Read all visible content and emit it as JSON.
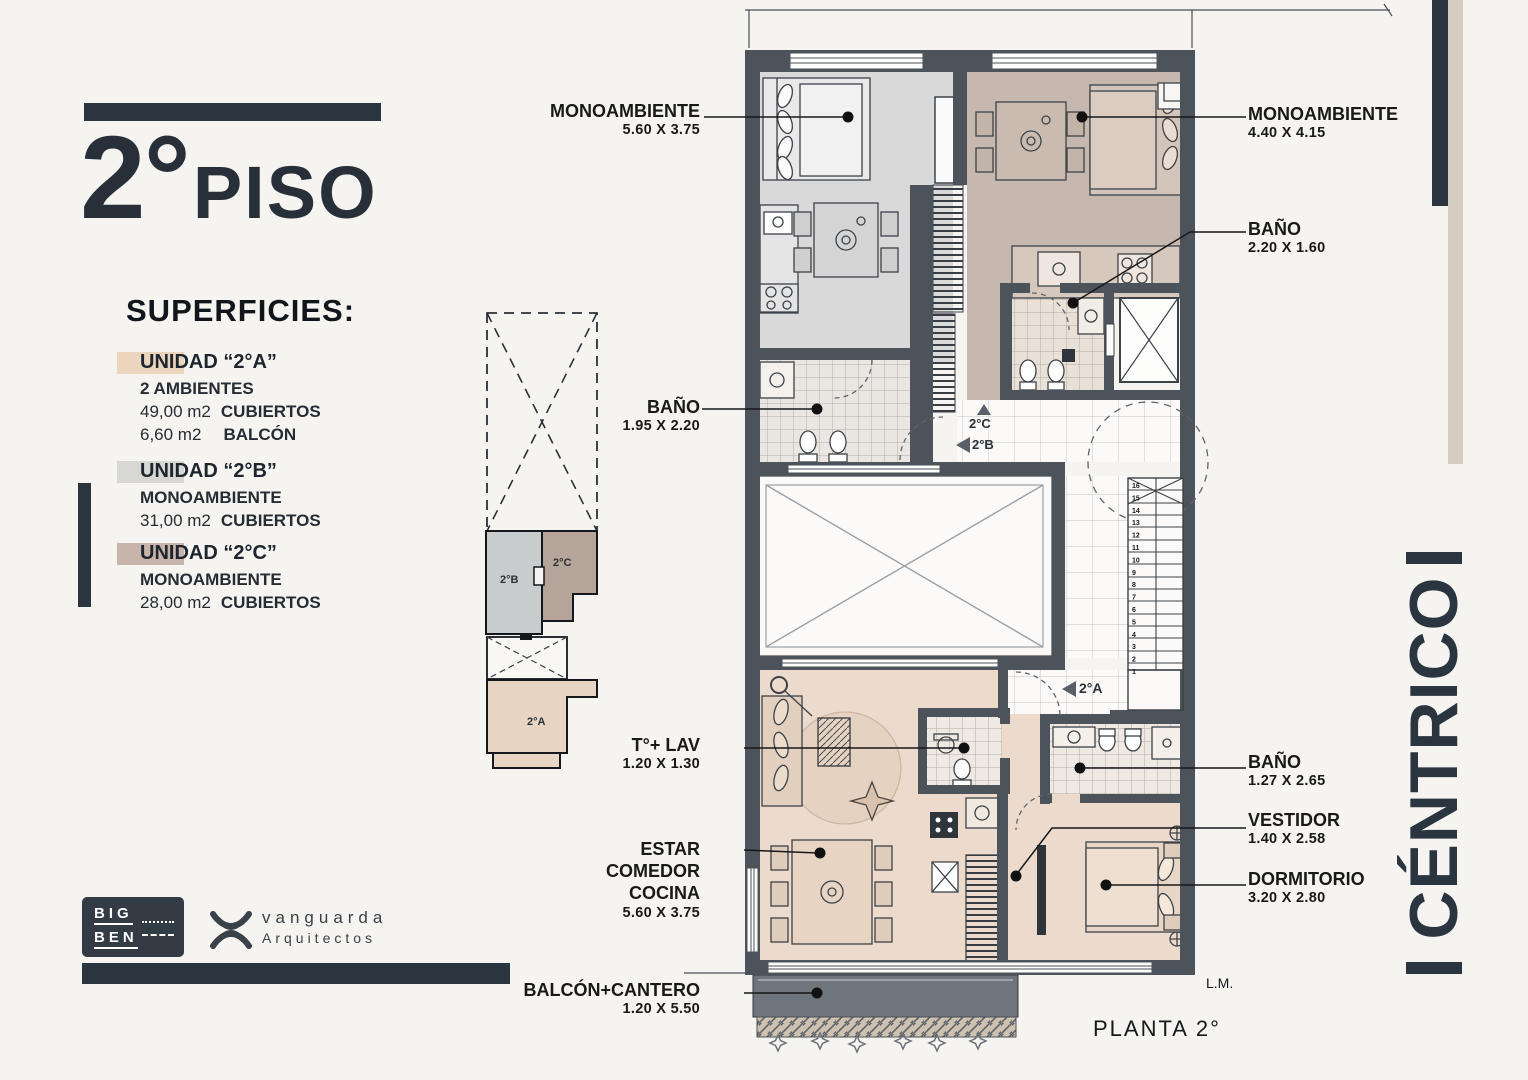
{
  "header": {
    "floor_number": "2°",
    "floor_word": "PISO"
  },
  "superficies": {
    "heading": "SUPERFICIES:",
    "unit_a": {
      "name": "UNIDAD “2°A”",
      "type": "2 AMBIENTES",
      "area1_value": "49,00 m2",
      "area1_label": "CUBIERTOS",
      "area2_value": "6,60 m2",
      "area2_label": "BALCÓN"
    },
    "unit_b": {
      "name": "UNIDAD “2°B”",
      "type": "MONOAMBIENTE",
      "area1_value": "31,00 m2",
      "area1_label": "CUBIERTOS"
    },
    "unit_c": {
      "name": "UNIDAD “2°C”",
      "type": "MONOAMBIENTE",
      "area1_value": "28,00 m2",
      "area1_label": "CUBIERTOS"
    }
  },
  "labels": {
    "mono_b": {
      "name": "MONOAMBIENTE",
      "dims": "5.60 X 3.75"
    },
    "mono_c": {
      "name": "MONOAMBIENTE",
      "dims": "4.40 X 4.15"
    },
    "bano_c": {
      "name": "BAÑO",
      "dims": "2.20 X 1.60"
    },
    "bano_b": {
      "name": "BAÑO",
      "dims": "1.95 X 2.20"
    },
    "toilette": {
      "name": "T°+ LAV",
      "dims": "1.20 X 1.30"
    },
    "estar": {
      "line1": "ESTAR",
      "line2": "COMEDOR",
      "line3": "COCINA",
      "dims": "5.60 X 3.75"
    },
    "balcon": {
      "name": "BALCÓN+CANTERO",
      "dims": "1.20 X 5.50"
    },
    "bano_a": {
      "name": "BAÑO",
      "dims": "1.27 X 2.65"
    },
    "vestidor": {
      "name": "VESTIDOR",
      "dims": "1.40 X 2.58"
    },
    "dormitorio": {
      "name": "DORMITORIO",
      "dims": "3.20 X 2.80"
    }
  },
  "plan": {
    "caption": "PLANTA 2°",
    "lm": "L.M.",
    "marks": {
      "unit_a": "2°A",
      "unit_b": "2°B",
      "unit_c": "2°C"
    },
    "stair_numbers": [
      16,
      15,
      14,
      13,
      12,
      11,
      10,
      9,
      8,
      7,
      6,
      5,
      4,
      3,
      2,
      1
    ]
  },
  "keyplan": {
    "unit_a": "2°A",
    "unit_b": "2°B",
    "unit_c": "2°C"
  },
  "brand": {
    "vertical_text": "CÉNTRICO",
    "bigben_top": "BIG",
    "bigben_bottom": "BEN",
    "studio_name": "vanguarda",
    "studio_sub": "Arquitectos"
  },
  "colors": {
    "ink": "#2b3540",
    "wall": "#4d535a",
    "floor_a": "#ecdbcc",
    "floor_b": "#d9d9d9",
    "floor_c": "#c7b8af",
    "balcony": "#6f757c",
    "chip_a": "#ecd5bd",
    "chip_b": "#d7d7d3",
    "chip_c": "#c8b4aa",
    "bar_beige": "#d5cdc1"
  }
}
